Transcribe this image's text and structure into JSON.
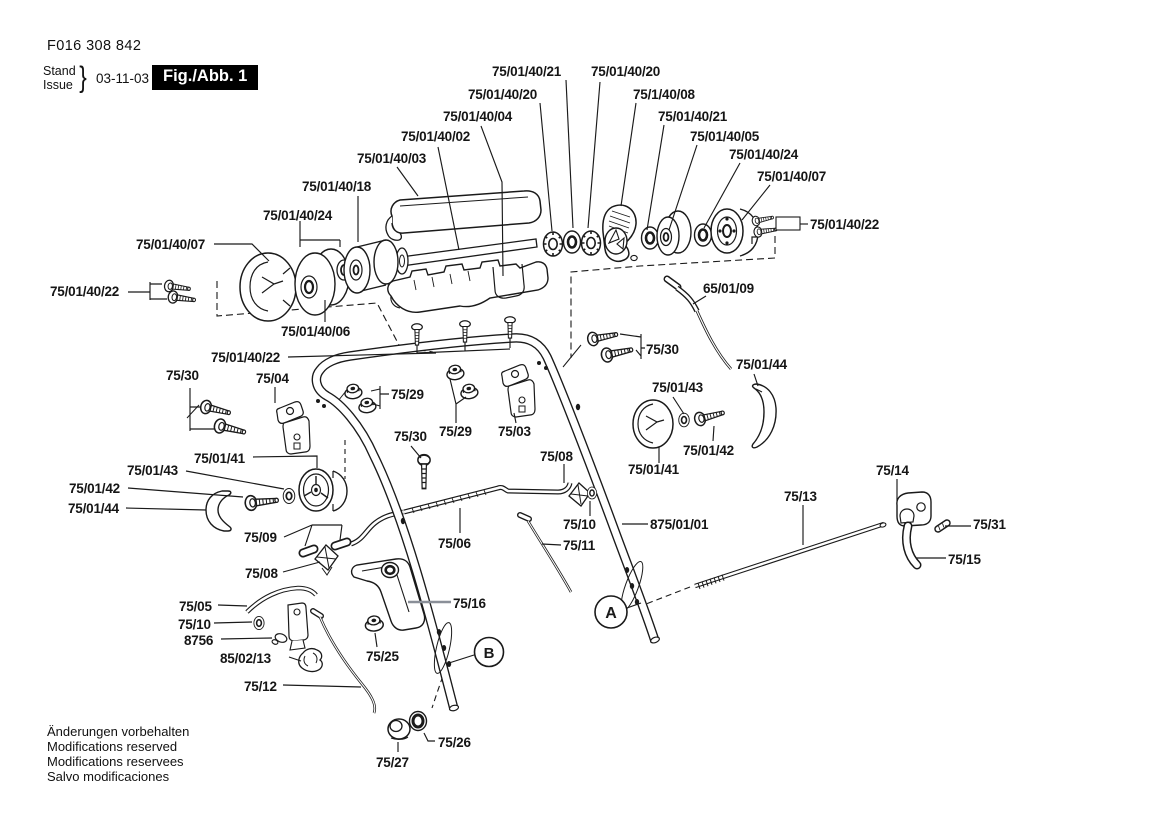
{
  "header": {
    "part_number": "F016 308 842",
    "stand_label": "Stand",
    "issue_label": "Issue",
    "brace": "}",
    "date": "03-11-03",
    "figure_label": "Fig./Abb. 1"
  },
  "footer": {
    "lines": [
      "Änderungen vorbehalten",
      "Modifications reserved",
      "Modifications reservees",
      "Salvo modificaciones"
    ]
  },
  "view_markers": [
    "A",
    "B"
  ],
  "colors": {
    "ink": "#1a1a1a",
    "background": "#ffffff",
    "figure_box": "#000000"
  },
  "labels": [
    "75/01/40/21",
    "75/01/40/20",
    "75/01/40/20",
    "75/1/40/08",
    "75/01/40/04",
    "75/01/40/21",
    "75/01/40/02",
    "75/01/40/05",
    "75/01/40/03",
    "75/01/40/24",
    "75/01/40/07",
    "75/01/40/18",
    "75/01/40/24",
    "75/01/40/22",
    "75/01/40/07",
    "65/01/09",
    "75/01/40/22",
    "75/01/40/06",
    "75/30",
    "75/01/40/22",
    "75/01/44",
    "75/30",
    "75/04",
    "75/01/43",
    "75/29",
    "75/29",
    "75/03",
    "75/30",
    "75/01/42",
    "75/08",
    "75/01/41",
    "75/14",
    "75/01/41",
    "75/01/43",
    "75/01/42",
    "75/13",
    "75/01/44",
    "75/10",
    "875/01/01",
    "75/31",
    "75/09",
    "75/06",
    "75/11",
    "75/15",
    "75/08",
    "75/05",
    "75/16",
    "75/10",
    "8756",
    "85/02/13",
    "75/25",
    "75/12",
    "75/26",
    "75/27"
  ]
}
